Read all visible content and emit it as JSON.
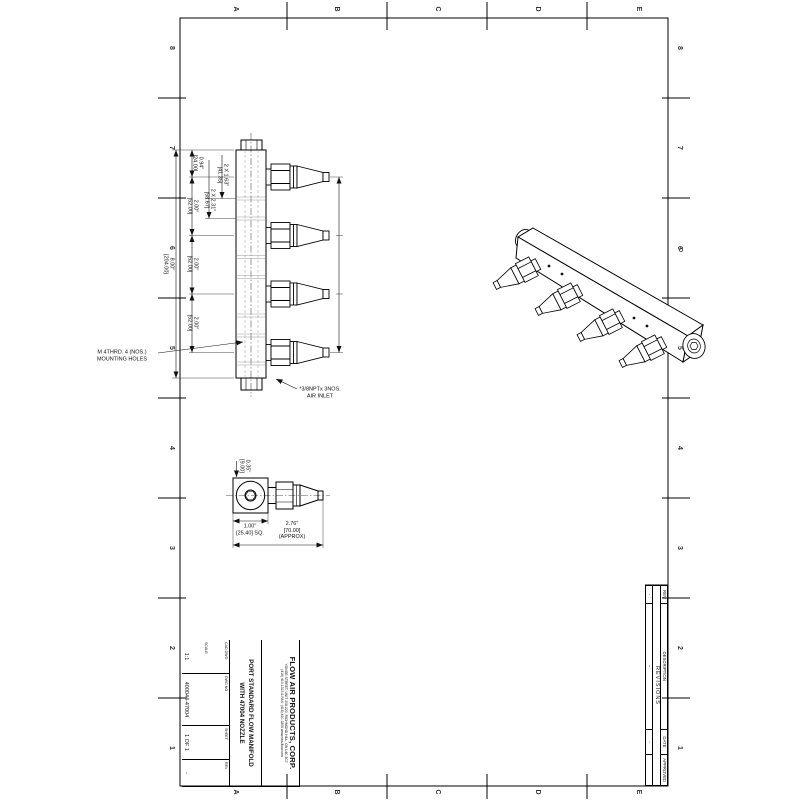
{
  "sheet": {
    "zones": {
      "columns": [
        "A",
        "B",
        "C",
        "D",
        "E"
      ],
      "rows": [
        "8",
        "7",
        "6",
        "5",
        "4",
        "3",
        "2",
        "1"
      ]
    }
  },
  "views": {
    "side": {
      "dims": {
        "overall": [
          "8.00\"",
          "[204.00]"
        ],
        "top_offset": [
          "0.94\"",
          "[24.00]"
        ],
        "pitch": [
          "2.00\"",
          "[52.00]"
        ],
        "port_a": [
          "2 X 1.63\"",
          "[41.35]"
        ],
        "port_b": [
          "2 X 2.31\"",
          "[58.67]"
        ]
      },
      "notes": {
        "mounting": [
          "M 4THRD. 4 (NOS.)",
          "MOUNTING HOLES"
        ],
        "inlet": [
          "*3/8NPTx 3NOS.",
          "AIR INLET"
        ]
      }
    },
    "detail": {
      "dims": {
        "orifice": [
          "0.35\"",
          "[9.00]"
        ],
        "square": [
          "1.00\"",
          "[25.40] SQ."
        ],
        "length": [
          "2.76\"",
          "[70.00]",
          "(APPROX)"
        ]
      }
    }
  },
  "title_block": {
    "company": "FLOW AIR PRODUCTS, CORP.",
    "address1": "YONGE STREET, UNIT 208-220, RICHMOND HILL, ON L4C 3C7",
    "address2": "(416) 410-1313 & FAX: (416) 410-1806   www.sea-flow.com",
    "title_line1": "PORT STANDARD FLOW MANIFOLD",
    "title_line2": "WITH 47004 NOZZLE",
    "cad": "CAD DWG",
    "scale_label": "SCALE",
    "scale": "1:1",
    "dwg_no_label": "DWG NO",
    "dwg_no": "400044-47004",
    "sheet_label": "SHEET",
    "sheet": "1 OF 1",
    "rev_label": "REV",
    "rev": "-"
  },
  "revisions": {
    "title": "REVISIONS",
    "headers": [
      "REV",
      "DESCRIPTION",
      "DATE",
      "APPROVED"
    ],
    "row": [
      "-",
      "--",
      "-",
      ""
    ]
  }
}
